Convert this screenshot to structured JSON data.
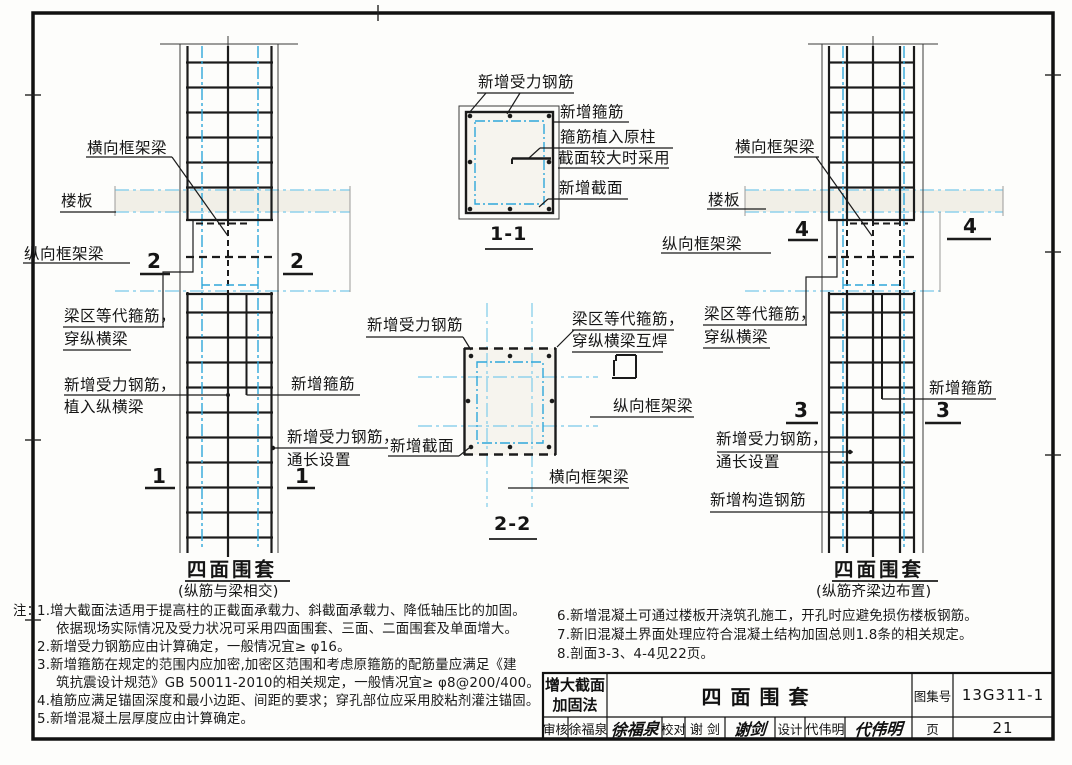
{
  "left_view": {
    "labels": {
      "transverse_beam": "横向框架梁",
      "slab": "楼板",
      "longitudinal_beam": "纵向框架梁",
      "equiv_stirrup_line1": "梁区等代箍筋，",
      "equiv_stirrup_line2": "穿纵横梁",
      "planted_bar_line1": "新增受力钢筋，",
      "planted_bar_line2": "植入纵横梁",
      "new_stirrup": "新增箍筋",
      "through_bar_line1": "新增受力钢筋，",
      "through_bar_line2": "通长设置"
    },
    "section_marks": {
      "upper": "2",
      "lower": "1"
    },
    "title": "四面围套",
    "subtitle": "(纵筋与梁相交)"
  },
  "detail_1_1": {
    "labels": {
      "new_main_bar": "新增受力钢筋",
      "new_stirrup": "新增箍筋",
      "stirrup_planted_line1": "箍筋植入原柱",
      "stirrup_planted_line2": "截面较大时采用",
      "new_section": "新增截面"
    },
    "title": "1-1"
  },
  "detail_2_2": {
    "labels": {
      "new_main_bar": "新增受力钢筋",
      "equiv_stirrup_line1": "梁区等代箍筋，",
      "equiv_stirrup_line2": "穿纵横梁互焊",
      "longitudinal_beam": "纵向框架梁",
      "new_section": "新增截面",
      "transverse_beam": "横向框架梁"
    },
    "title": "2-2"
  },
  "right_view": {
    "labels": {
      "transverse_beam": "横向框架梁",
      "slab": "楼板",
      "longitudinal_beam": "纵向框架梁",
      "equiv_stirrup_line1": "梁区等代箍筋，",
      "equiv_stirrup_line2": "穿纵横梁",
      "new_stirrup": "新增箍筋",
      "through_bar_line1": "新增受力钢筋，",
      "through_bar_line2": "通长设置",
      "new_construct_bar": "新增构造钢筋"
    },
    "section_marks": {
      "upper": "4",
      "lower": "3"
    },
    "title": "四面围套",
    "subtitle": "(纵筋齐梁边布置)"
  },
  "notes": {
    "prefix": "注：",
    "left": [
      "1.增大截面法适用于提高柱的正截面承载力、斜截面承载力、降低轴压比的加固。",
      "依据现场实际情况及受力状况可采用四面围套、三面、二面围套及单面增大。",
      "2.新增受力钢筋应由计算确定，一般情况宜≥ φ16。",
      "3.新增箍筋在规定的范围内应加密,加密区范围和考虑原箍筋的配筋量应满足《建",
      "筑抗震设计规范》GB 50011-2010的相关规定，一般情况宜≥ φ8@200/400。",
      "4.植筋应满足锚固深度和最小边距、间距的要求；穿孔部位应采用胶粘剂灌注锚固。",
      "5.新增混凝土层厚度应由计算确定。"
    ],
    "right": [
      "6.新增混凝土可通过楼板开浇筑孔施工，开孔时应避免损伤楼板钢筋。",
      "7.新旧混凝土界面处理应符合混凝土结构加固总则1.8条的相关规定。",
      "8.剖面3-3、4-4见22页。"
    ]
  },
  "title_block": {
    "method_line1": "增大截面",
    "method_line2": "加固法",
    "drawing_title": "四面围套",
    "atlas_no_label": "图集号",
    "atlas_no": "13G311-1",
    "page_label": "页",
    "page_no": "21",
    "review_label": "审核",
    "review_name": "徐福泉",
    "review_sig": "徐福泉",
    "proof_label": "校对",
    "proof_name": "谢 剑",
    "proof_sig": "谢剑",
    "design_label": "设计",
    "design_name": "代伟明",
    "design_sig": "代伟明"
  }
}
